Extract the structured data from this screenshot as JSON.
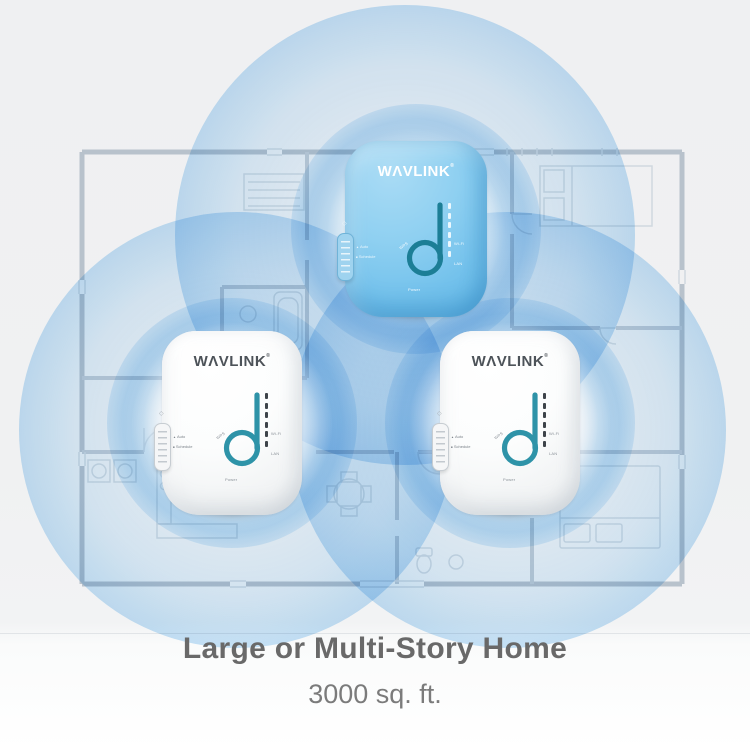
{
  "caption": {
    "title": "Large or Multi-Story Home",
    "subtitle": "3000 sq. ft."
  },
  "brand": {
    "name": "WAVLINK",
    "logo_display": "WΛVLINK",
    "registered_mark": "®"
  },
  "device_labels": {
    "wps": "WPS",
    "power": "Power",
    "wifi": "Wi-Fi",
    "lan": "LAN",
    "switch_bullet_top": "▲",
    "switch_option_top": "Auto",
    "switch_bullet_bottom": "■",
    "switch_option_bottom": "Schedule"
  },
  "icons": {
    "lamp": "◇"
  },
  "devices": [
    {
      "id": "device-top",
      "body_color": "blue"
    },
    {
      "id": "device-left",
      "body_color": "white"
    },
    {
      "id": "device-right",
      "body_color": "white"
    }
  ],
  "coverage": {
    "circle_count": 3,
    "fill_color": "#a9d5f3"
  },
  "colors": {
    "background": "#f0f1f2",
    "coverage_blue": "#a9d5f3",
    "device_body_blue": "#7cc6ed",
    "signal_ring_teal": "#2e93a8",
    "signal_ring_teal_dark": "#1c7e96",
    "caption_text": "#696969",
    "floorplan_line": "#c3ccd6"
  }
}
